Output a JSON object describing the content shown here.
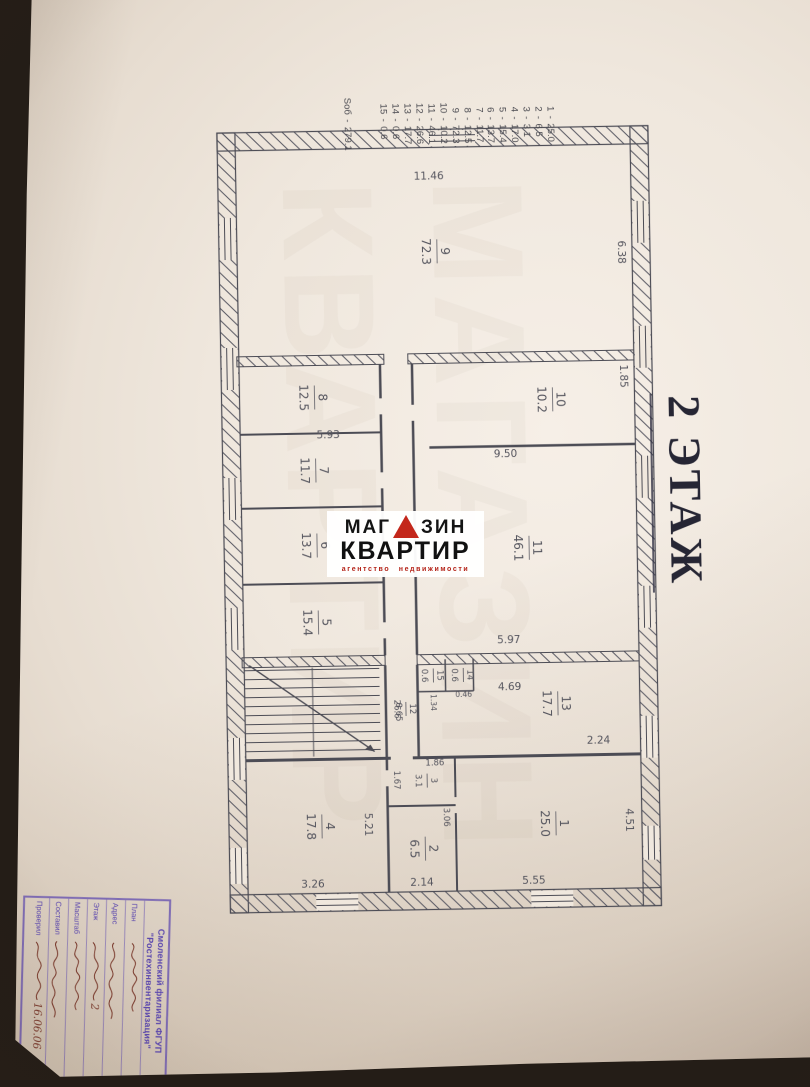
{
  "floor_header": "2 ЭТАЖ",
  "room_list": {
    "separator": "-",
    "entries": [
      {
        "n": "1",
        "v": "25.0"
      },
      {
        "n": "2",
        "v": "6.5"
      },
      {
        "n": "3",
        "v": "3.1"
      },
      {
        "n": "4",
        "v": "17.0"
      },
      {
        "n": "5",
        "v": "15.4"
      },
      {
        "n": "6",
        "v": "13.7"
      },
      {
        "n": "7",
        "v": "11.7"
      },
      {
        "n": "8",
        "v": "12.5"
      },
      {
        "n": "9",
        "v": "72.3"
      },
      {
        "n": "10",
        "v": "10.2"
      },
      {
        "n": "11",
        "v": "46.1"
      },
      {
        "n": "12",
        "v": "26.6"
      },
      {
        "n": "13",
        "v": "17.7"
      },
      {
        "n": "14",
        "v": "0.6"
      },
      {
        "n": "15",
        "v": "0.6"
      }
    ],
    "total_label": "Sоб",
    "total_value": "279.1"
  },
  "plan": {
    "rooms": [
      {
        "num": "9",
        "area": "72.3",
        "x": 252,
        "y": 365
      },
      {
        "num": "10",
        "area": "10.2",
        "x": 402,
        "y": 252
      },
      {
        "num": "11",
        "area": "46.1",
        "x": 550,
        "y": 278
      },
      {
        "num": "13",
        "area": "17.7",
        "x": 706,
        "y": 252
      },
      {
        "num": "1",
        "area": "25.0",
        "x": 826,
        "y": 256
      },
      {
        "num": "14",
        "area": "0.6",
        "x": 676,
        "y": 346,
        "small": true
      },
      {
        "num": "15",
        "area": "0.6",
        "x": 676,
        "y": 376,
        "small": true
      },
      {
        "num": "12",
        "area": "26.6",
        "x": 709,
        "y": 404,
        "small": true
      },
      {
        "num": "3",
        "area": "3.1",
        "x": 781,
        "y": 384,
        "small": true
      },
      {
        "num": "2",
        "area": "6.5",
        "x": 849,
        "y": 387
      },
      {
        "num": "8",
        "area": "12.5",
        "x": 396,
        "y": 490
      },
      {
        "num": "7",
        "area": "11.7",
        "x": 469,
        "y": 490
      },
      {
        "num": "6",
        "area": "13.7",
        "x": 544,
        "y": 490
      },
      {
        "num": "5",
        "area": "15.4",
        "x": 621,
        "y": 490
      },
      {
        "num": "4",
        "area": "17.8",
        "x": 825,
        "y": 490
      }
    ],
    "dims": [
      {
        "t": "11.46",
        "x": 180,
        "y": 372,
        "r": -90
      },
      {
        "t": "6.38",
        "x": 256,
        "y": 184,
        "r": 0
      },
      {
        "t": "1.85",
        "x": 380,
        "y": 184,
        "r": 0
      },
      {
        "t": "9.50",
        "x": 459,
        "y": 300,
        "r": -90
      },
      {
        "t": "5.97",
        "x": 645,
        "y": 300,
        "r": -90
      },
      {
        "t": "5.93",
        "x": 437,
        "y": 477,
        "r": -90
      },
      {
        "t": "4.69",
        "x": 692,
        "y": 300,
        "r": -90
      },
      {
        "t": "2.24",
        "x": 747,
        "y": 212,
        "r": -90
      },
      {
        "t": "8.65",
        "x": 712,
        "y": 414,
        "r": 0,
        "s": 8.5
      },
      {
        "t": "0.46",
        "x": 698,
        "y": 346,
        "r": -90,
        "s": 7.5
      },
      {
        "t": "1.34",
        "x": 703,
        "y": 379,
        "r": 0,
        "s": 7.5
      },
      {
        "t": "1.86",
        "x": 766,
        "y": 376,
        "r": -90,
        "s": 8.5
      },
      {
        "t": "1.67",
        "x": 780,
        "y": 417,
        "r": 0,
        "s": 8.5
      },
      {
        "t": "3.06",
        "x": 818,
        "y": 368,
        "r": 0,
        "s": 8.5
      },
      {
        "t": "2.14",
        "x": 886,
        "y": 391,
        "r": -90
      },
      {
        "t": "3.26",
        "x": 886,
        "y": 500,
        "r": -90
      },
      {
        "t": "5.21",
        "x": 824,
        "y": 447,
        "r": 0
      },
      {
        "t": "5.55",
        "x": 886,
        "y": 279,
        "r": -90
      },
      {
        "t": "4.51",
        "x": 824,
        "y": 186,
        "r": 0
      }
    ]
  },
  "stamp": {
    "org_line1": "Смоленский филиал ФГУП",
    "org_line2": "\"Ростехинвентаризация\"",
    "rows": [
      {
        "label": "План",
        "value": ""
      },
      {
        "label": "Адрес",
        "value": ""
      },
      {
        "label": "Этаж",
        "value": "2"
      },
      {
        "label": "Масштаб",
        "value": ""
      },
      {
        "label": "Составил",
        "value": ""
      },
      {
        "label": "Проверил",
        "value": "16.06.06"
      }
    ]
  },
  "watermark": {
    "word1_prefix": "МАГ",
    "word1_suffix": "ЗИН",
    "word2": "КВАРТИР",
    "tagline": "агентство недвижимости",
    "accent_color": "#c3271b",
    "tagline_color": "#b42318"
  },
  "ghost": {
    "line1": "МАГАЗИН",
    "line2": "КВАРТИР"
  },
  "colors": {
    "plan_line": "#4c4c55",
    "plan_text": "#55555e",
    "stamp_ink": "#5a46ae",
    "handwriting_ink": "#7a3a2d",
    "paper": "#efe7dd",
    "background": "#241d17"
  }
}
